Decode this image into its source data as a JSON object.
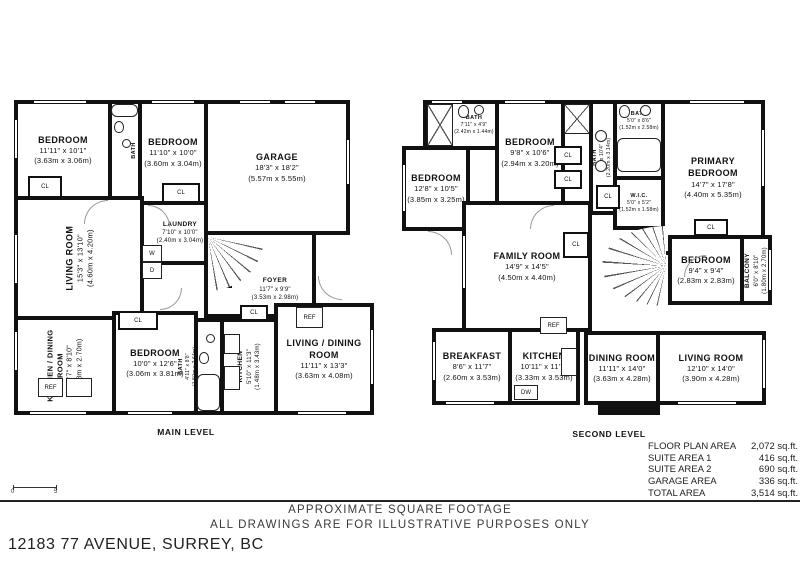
{
  "page": {
    "address": "12183 77 AVENUE, SURREY, BC",
    "caption_line1": "APPROXIMATE SQUARE FOOTAGE",
    "caption_line2": "ALL DRAWINGS ARE FOR ILLUSTRATIVE PURPOSES ONLY"
  },
  "scale_bar": {
    "start": "0",
    "end": "5"
  },
  "labels": {
    "cl": "CL",
    "ref": "REF",
    "dw": "DW",
    "washer": "W",
    "dryer": "D"
  },
  "levels": [
    {
      "name": "MAIN LEVEL",
      "rooms": [
        {
          "name": "BEDROOM",
          "imperial": "11'11\" x 10'1\"",
          "metric": "(3.63m x 3.06m)"
        },
        {
          "name": "BATH",
          "imperial": "8'6\" x 4'10\"",
          "metric": "(2.60m x 1.48m)"
        },
        {
          "name": "BEDROOM",
          "imperial": "11'10\" x 10'0\"",
          "metric": "(3.60m x 3.04m)"
        },
        {
          "name": "GARAGE",
          "imperial": "18'3\" x 18'2\"",
          "metric": "(5.57m x 5.55m)"
        },
        {
          "name": "LAUNDRY",
          "imperial": "7'10\" x 10'0\"",
          "metric": "(2.40m x 3.04m)"
        },
        {
          "name": "LIVING ROOM",
          "imperial": "15'3\" x 13'10\"",
          "metric": "(4.60m x 4.20m)"
        },
        {
          "name": "FOYER",
          "imperial": "11'7\" x 9'9\"",
          "metric": "(3.53m x 2.98m)"
        },
        {
          "name": "KITCHEN / DINING ROOM",
          "imperial": "12'7\" x 8'10\"",
          "metric": "(3.78m x 2.70m)"
        },
        {
          "name": "BEDROOM",
          "imperial": "10'0\" x 12'6\"",
          "metric": "(3.06m x 3.81m)"
        },
        {
          "name": "BATH",
          "imperial": "4'11\" x 8'8\"",
          "metric": "(1.50m x 2.64m)"
        },
        {
          "name": "KITCHEN",
          "imperial": "5'10\" x 11'3\"",
          "metric": "(1.48m x 3.43m)"
        },
        {
          "name": "LIVING / DINING ROOM",
          "imperial": "11'11\" x 13'3\"",
          "metric": "(3.63m x 4.08m)"
        }
      ]
    },
    {
      "name": "SECOND LEVEL",
      "rooms": [
        {
          "name": "BEDROOM",
          "imperial": "12'8\" x 10'5\"",
          "metric": "(3.85m x 3.25m)"
        },
        {
          "name": "BATH",
          "imperial": "7'11\" x 4'9\"",
          "metric": "(2.42m x 1.44m)"
        },
        {
          "name": "BEDROOM",
          "imperial": "9'8\" x 10'6\"",
          "metric": "(2.94m x 3.20m)"
        },
        {
          "name": "BATH",
          "imperial": "7'3\" x 10'4\"",
          "metric": "(2.20m x 3.14m)"
        },
        {
          "name": "PRIMARY BEDROOM",
          "imperial": "14'7\" x 17'8\"",
          "metric": "(4.40m x 5.35m)"
        },
        {
          "name": "BATH",
          "imperial": "5'0\" x 8'6\"",
          "metric": "(1.52m x 2.58m)"
        },
        {
          "name": "W.I.C.",
          "imperial": "5'0\" x 5'2\"",
          "metric": "(1.52m x 1.58m)"
        },
        {
          "name": "FAMILY ROOM",
          "imperial": "14'9\" x 14'5\"",
          "metric": "(4.50m x 4.40m)"
        },
        {
          "name": "BEDROOM",
          "imperial": "9'4\" x 9'4\"",
          "metric": "(2.83m x 2.83m)"
        },
        {
          "name": "BALCONY",
          "imperial": "6'0\" x 8'10\"",
          "metric": "(1.80m x 2.70m)"
        },
        {
          "name": "BREAKFAST",
          "imperial": "8'6\" x 11'7\"",
          "metric": "(2.60m x 3.53m)"
        },
        {
          "name": "KITCHEN",
          "imperial": "10'11\" x 11'7\"",
          "metric": "(3.33m x 3.53m)"
        },
        {
          "name": "DINING ROOM",
          "imperial": "11'11\" x 14'0\"",
          "metric": "(3.63m x 4.28m)"
        },
        {
          "name": "LIVING ROOM",
          "imperial": "12'10\" x 14'0\"",
          "metric": "(3.90m x 4.28m)"
        }
      ]
    }
  ],
  "area_table": {
    "rows": [
      {
        "label": "FLOOR PLAN AREA",
        "value": "2,072 sq.ft."
      },
      {
        "label": "SUITE AREA 1",
        "value": "416 sq.ft."
      },
      {
        "label": "SUITE AREA 2",
        "value": "690 sq.ft."
      },
      {
        "label": "GARAGE AREA",
        "value": "336 sq.ft."
      },
      {
        "label": "TOTAL AREA",
        "value": "3,514 sq.ft."
      }
    ]
  }
}
